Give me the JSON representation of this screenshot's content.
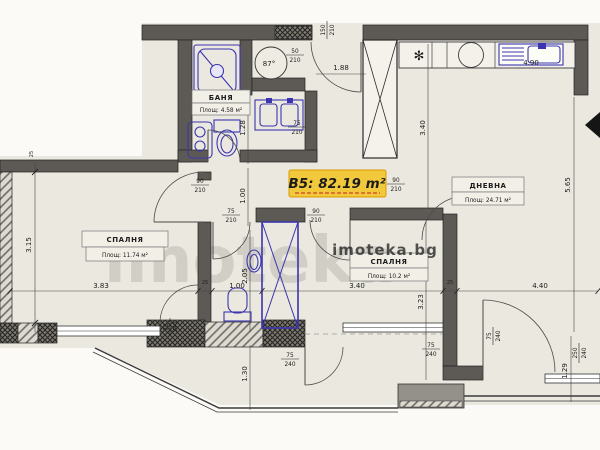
{
  "plan": {
    "unit_label": "B5: 82.19 m²",
    "watermark": "imoteka.bg",
    "watermark_large": "imoteka",
    "rooms": {
      "bedroom1": {
        "name": "СПАЛНЯ",
        "area": "Площ: 11.74 м²"
      },
      "living": {
        "name": "ДНЕВНА",
        "area": "Площ: 24.71 м²"
      },
      "bedroom2": {
        "name": "СПАЛНЯ",
        "area": "Площ: 10.2 м²"
      },
      "bath": {
        "name": "БАНЯ",
        "area": "Площ: 4.58 м²"
      }
    },
    "dims": {
      "chain_1": "3.83",
      "chain_2": "1.00",
      "chain_3": "3.40",
      "chain_4": "4.40",
      "left_v": "3.15",
      "hall_v": "1.00",
      "bath_v": "1.28",
      "wc_v": "2.05",
      "balcony_v": "1.30",
      "kitchen_v": "3.40",
      "bed2_v": "3.23",
      "right_v": "5.65",
      "right_v2": "1.29",
      "entry_w": "1.88",
      "kitchen_w": "4.90",
      "wall_a": "25",
      "wall_b": "25",
      "wall_c": "25",
      "boiler_d": "87°"
    },
    "openings": {
      "entrance": {
        "w": "150",
        "h": "210"
      },
      "boiler": {
        "w": "50",
        "h": "210"
      },
      "bath": {
        "w": "75",
        "h": "210"
      },
      "bedroom1": {
        "w": "90",
        "h": "210"
      },
      "wc": {
        "w": "75",
        "h": "210"
      },
      "bedroom2": {
        "w": "90",
        "h": "210"
      },
      "living": {
        "w": "90",
        "h": "210"
      },
      "balcony1": {
        "w": "75",
        "h": "240"
      },
      "balcony2": {
        "w": "75",
        "h": "240"
      },
      "balcony3": {
        "w": "75",
        "h": "240"
      },
      "balcony4": {
        "w": "75",
        "h": "240"
      },
      "window_br": {
        "w": "250",
        "h": "240"
      }
    }
  }
}
